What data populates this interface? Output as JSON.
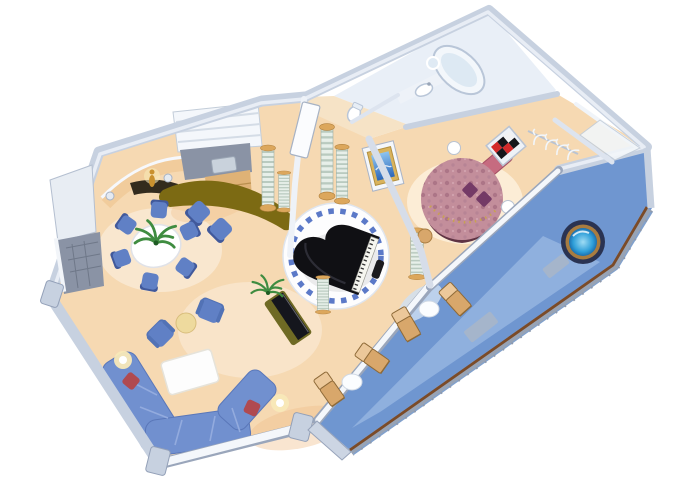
{
  "illustration": {
    "title": "Isometric cutaway floor plan of a luxury ship suite",
    "style": "3d-isometric-floorplan",
    "background": "#ffffff"
  },
  "colors": {
    "background": "#ffffff",
    "wall_fill": "#c7d1e0",
    "wall_edge": "#93a0b8",
    "wall_white": "#f7f9fc",
    "wall_inner": "#dde4ef",
    "floor_living": "#f6d9b2",
    "floor_glow": "#fdf0dc",
    "floor_warm": "#f0bf8a",
    "floor_entry": "#f6e3c6",
    "floor_bath": "#e9eff7",
    "platform_white": "#fdfdfe",
    "tile_blue": "#5b79c8",
    "piano_black": "#101014",
    "piano_keys": "#f6f6f0",
    "column_gold": "#dca75c",
    "bar_olive": "#7c6a13",
    "counter_dark": "#332b1d",
    "statue_gold": "#c9912f",
    "table_white": "#ffffff",
    "chair_blue": "#6080c5",
    "chair_back": "#41599b",
    "sofa_blue": "#7190cf",
    "pillow_red": "#b04a50",
    "rug_white": "#fdfdfd",
    "side_table_cream": "#eeda9e",
    "lamp_glow": "#f8e9b8",
    "plant_green": "#3f8c40",
    "tv_dark": "#15161d",
    "console_olive": "#6f6a24",
    "desk_gray": "#8a93a5",
    "wood_tan": "#dfb276",
    "bed_mauve": "#c38e9b",
    "bed_skirt": "#5f3343",
    "headboard_pink": "#c66b80",
    "pillow_purple": "#743a66",
    "art_red": "#d42a2a",
    "art_black": "#16161a",
    "tub_white": "#f3f7fb",
    "fixture_white": "#ffffff",
    "hanger_white": "#f2f6fa",
    "deck_blue": "#6f96d0",
    "deck_light": "#a5c1e8",
    "deck_dark": "#4c79b8",
    "rail_brown": "#7b4b28",
    "lounger_tan": "#d8a76b",
    "balcony_table": "#fbfdff",
    "hottub_rim": "#2a3352",
    "hottub_ring": "#a87c40",
    "hottub_water": "#2f9fd9",
    "mat_gray": "#aab6c6",
    "door_white": "#fbfcfe",
    "screen_blue": "#3b86d8",
    "frame_gold": "#d9b35c"
  },
  "rooms": [
    {
      "id": "living-dining",
      "label": "Living and dining room",
      "furniture": [
        "round dining table",
        "6 dining chairs",
        "2 bar chairs",
        "curved wet bar",
        "statue niche",
        "louvered sideboard",
        "desk",
        "wood cabinet",
        "minibar cabinet",
        "sectional sofa",
        "2 red accent pillows",
        "2 armchairs",
        "round side table",
        "coffee table",
        "tv console",
        "2 floor lamps",
        "2 palm plants"
      ]
    },
    {
      "id": "music-parlor",
      "label": "Piano parlor",
      "furniture": [
        "baby grand piano",
        "piano bench",
        "circular marble platform with blue tile ring",
        "6 classical columns"
      ]
    },
    {
      "id": "bedroom",
      "label": "Master bedroom",
      "furniture": [
        "round bed",
        "pink headboard",
        "checkered wall art",
        "2 nightstands",
        "gold-framed wall tv",
        "vanity stool"
      ]
    },
    {
      "id": "bathroom",
      "label": "Bathroom",
      "furniture": [
        "oval bathtub",
        "vanity sink",
        "mirror",
        "toilet"
      ]
    },
    {
      "id": "closet",
      "label": "Walk-in closet",
      "furniture": [
        "closet rod",
        "4 hangers",
        "corner shelf"
      ]
    },
    {
      "id": "balcony",
      "label": "Private balcony",
      "furniture": [
        "whirlpool hot tub",
        "4 chaise loungers",
        "2 round tables",
        "2 deck mats",
        "wood-top railing"
      ]
    }
  ]
}
